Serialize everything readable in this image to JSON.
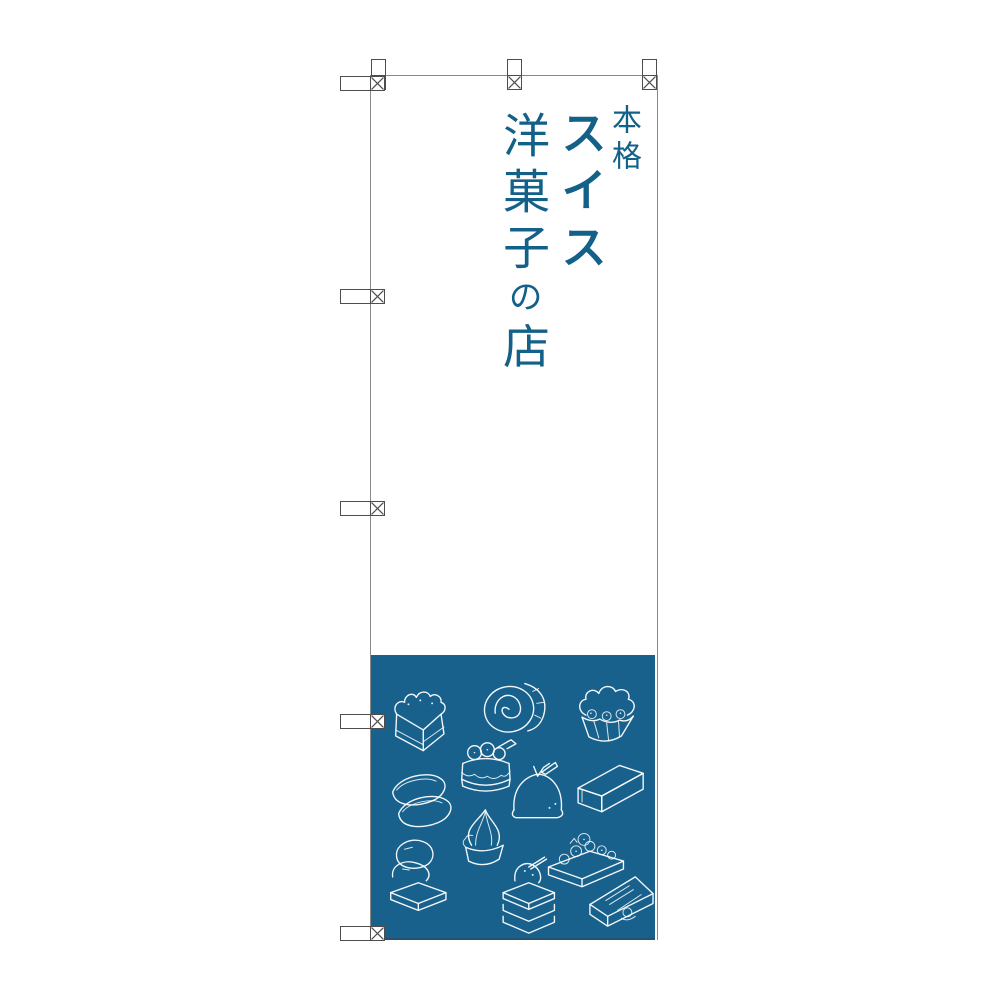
{
  "banner": {
    "text": {
      "prefix": "本格",
      "main_word": "スイス",
      "secondary_word": "洋菓子",
      "particle": "の",
      "suffix": "店"
    },
    "colors": {
      "text_blue": "#136089",
      "panel_blue": "#17618c",
      "outline_gray": "#8a8a8a",
      "tab_outline_gray": "#4d4d4d",
      "panel_edge": "#27506d"
    },
    "illustrations": [
      "square-shortcake",
      "swiss-roll",
      "cupcake",
      "strawberry-shortcake",
      "ladyfinger-pair",
      "dome-cake",
      "pound-cake",
      "macaron-burger",
      "soft-serve-cup",
      "mille-feuille",
      "berry-tart",
      "cake-slice"
    ]
  }
}
